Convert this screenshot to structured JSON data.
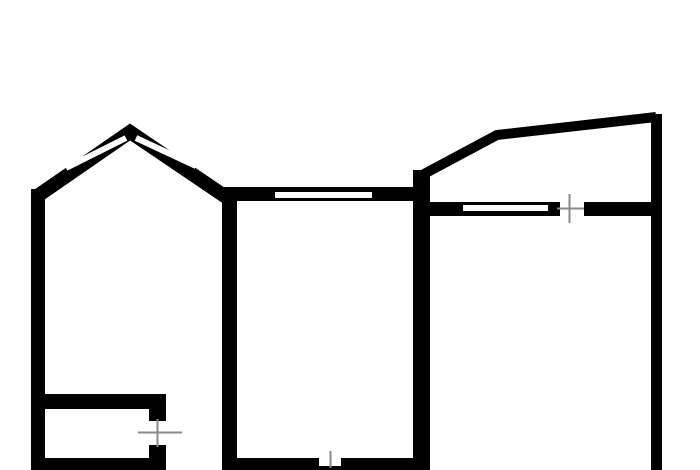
{
  "canvas": {
    "width": 700,
    "height": 470,
    "background": "#ffffff"
  },
  "colors": {
    "wall": "#000000",
    "window": "#ffffff",
    "tick": "#8a8a8a"
  },
  "floorplan": {
    "kind": "apartment-floor-plan",
    "wall_rects": [
      {
        "name": "left-outer-wall",
        "x": 31,
        "y": 189,
        "w": 14,
        "h": 281
      },
      {
        "name": "living-room-divider-wall",
        "x": 222,
        "y": 192,
        "w": 15,
        "h": 278
      },
      {
        "name": "middle-room-top-wall",
        "x": 222,
        "y": 187,
        "w": 206,
        "h": 14
      },
      {
        "name": "center-right-wall",
        "x": 413,
        "y": 170,
        "w": 17,
        "h": 300
      },
      {
        "name": "right-room-top-wall-left",
        "x": 428,
        "y": 202,
        "w": 132,
        "h": 14
      },
      {
        "name": "right-room-top-wall-right",
        "x": 584,
        "y": 202,
        "w": 78,
        "h": 14
      },
      {
        "name": "right-outer-wall",
        "x": 651,
        "y": 114,
        "w": 11,
        "h": 356
      },
      {
        "name": "closet-top-wall",
        "x": 31,
        "y": 394,
        "w": 135,
        "h": 15
      },
      {
        "name": "closet-door-jamb-upper",
        "x": 149,
        "y": 394,
        "w": 17,
        "h": 27
      },
      {
        "name": "closet-door-jamb-lower",
        "x": 149,
        "y": 445,
        "w": 17,
        "h": 25
      },
      {
        "name": "closet-bottom-wall",
        "x": 31,
        "y": 458,
        "w": 119,
        "h": 12
      },
      {
        "name": "middle-room-bottom-wall",
        "x": 222,
        "y": 458,
        "w": 206,
        "h": 12
      }
    ],
    "wall_paths": [
      {
        "name": "bay-window-peaked-wall",
        "d": "M 36 197 L 130 132 L 226 197",
        "stroke_width": 14
      },
      {
        "name": "balcony-outline-wall",
        "d": "M 424 174 L 497 135 L 656 117",
        "stroke_width": 10
      }
    ],
    "window_lines": [
      {
        "name": "bay-left-window",
        "x1": 66,
        "y1": 168,
        "x2": 126,
        "y2": 138,
        "stroke_width": 6
      },
      {
        "name": "bay-right-window",
        "x1": 136,
        "y1": 138,
        "x2": 196,
        "y2": 166,
        "stroke_width": 6
      }
    ],
    "window_rects": [
      {
        "name": "middle-room-window",
        "x": 275,
        "y": 192,
        "w": 97,
        "h": 6
      },
      {
        "name": "right-room-window",
        "x": 463,
        "y": 205,
        "w": 85,
        "h": 6
      },
      {
        "name": "bottom-wall-door-notch",
        "x": 319,
        "y": 458,
        "w": 22,
        "h": 8
      }
    ],
    "tick_lines": [
      {
        "name": "right-room-door-tick-vertical",
        "x1": 569.5,
        "y1": 194,
        "x2": 569.5,
        "y2": 223,
        "stroke_width": 2
      },
      {
        "name": "right-room-door-tick-horizontal",
        "x1": 557,
        "y1": 208.5,
        "x2": 584,
        "y2": 208.5,
        "stroke_width": 2
      },
      {
        "name": "closet-door-tick-vertical",
        "x1": 157.5,
        "y1": 419,
        "x2": 157.5,
        "y2": 447,
        "stroke_width": 2
      },
      {
        "name": "closet-door-tick-horizontal",
        "x1": 138,
        "y1": 432.5,
        "x2": 182,
        "y2": 432.5,
        "stroke_width": 2
      },
      {
        "name": "bottom-wall-door-tick-vertical",
        "x1": 330.5,
        "y1": 451,
        "x2": 330.5,
        "y2": 468,
        "stroke_width": 2
      }
    ]
  }
}
